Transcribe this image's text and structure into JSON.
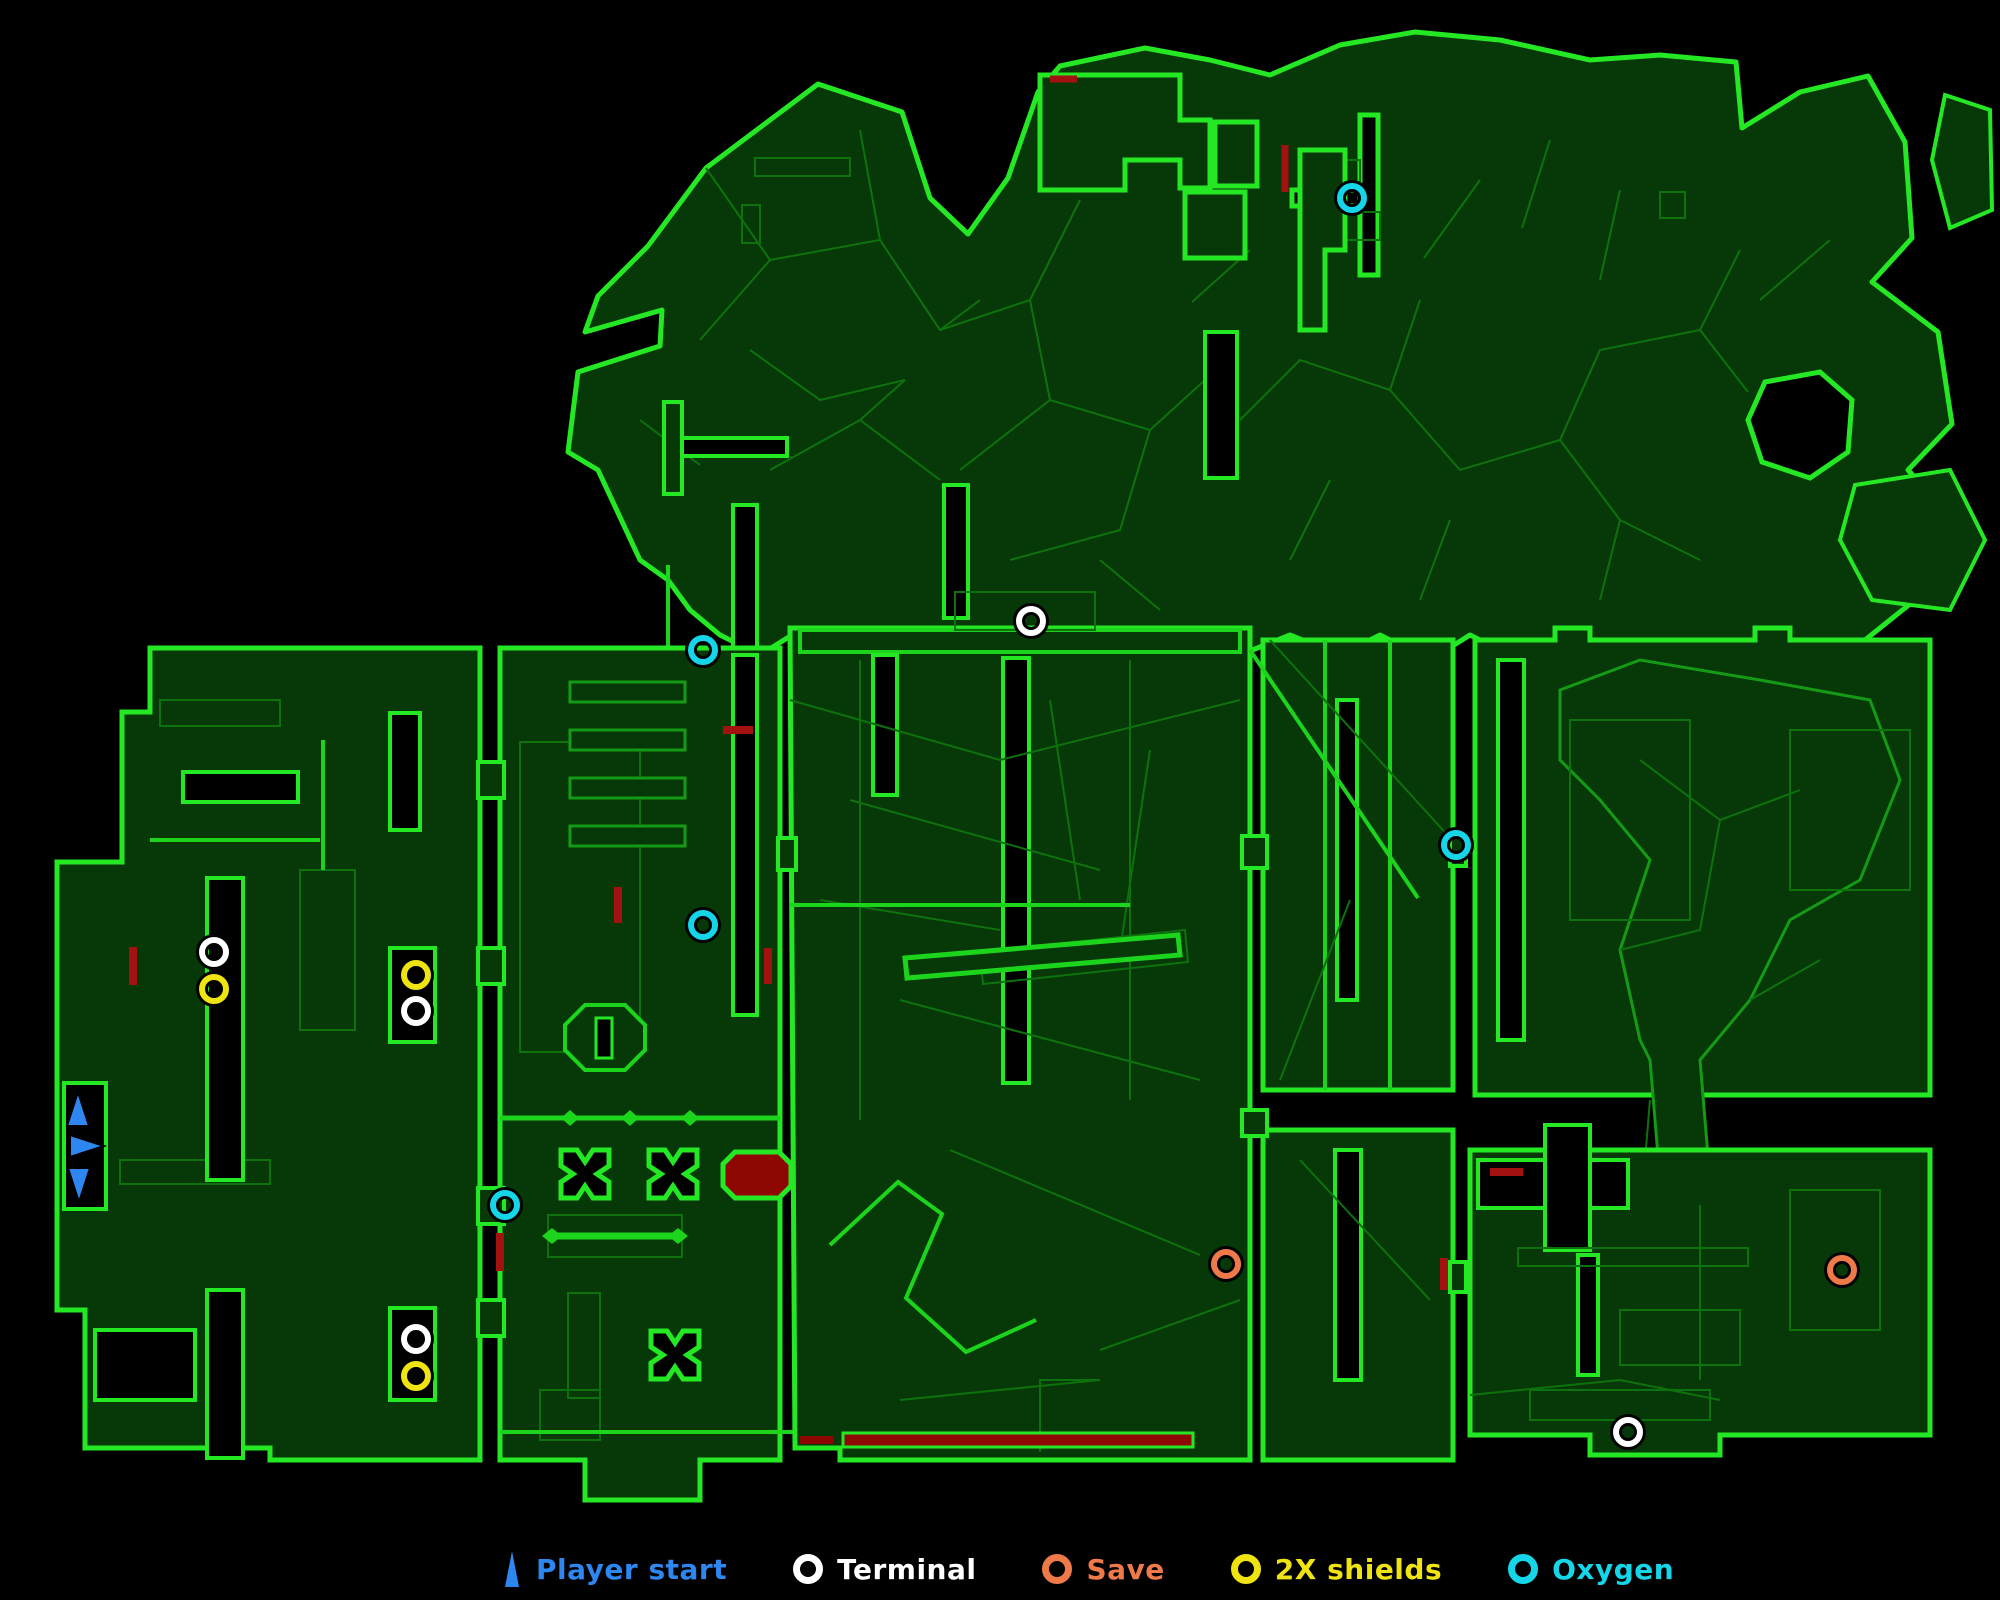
{
  "map": {
    "name": "overhead-automap",
    "colors": {
      "background": "#000000",
      "floor_fill": "#073807",
      "mesh_dim": "#0d720d",
      "mesh_mid": "#149a14",
      "outline_bright": "#24e824",
      "corridor": "#1bd41b",
      "hazard_red_fill": "#8e0703",
      "door_red": "#a31111"
    }
  },
  "legend": {
    "items": [
      {
        "id": "player-start",
        "label": "Player start",
        "color": "#2e86f0",
        "icon": "triangle"
      },
      {
        "id": "terminal",
        "label": "Terminal",
        "color": "#ffffff",
        "icon": "ring"
      },
      {
        "id": "save",
        "label": "Save",
        "color": "#f0794a",
        "icon": "ring"
      },
      {
        "id": "shields",
        "label": "2X shields",
        "color": "#efe312",
        "icon": "ring"
      },
      {
        "id": "oxygen",
        "label": "Oxygen",
        "color": "#14d6e8",
        "icon": "ring"
      }
    ]
  },
  "scale": {
    "label": "4 WU",
    "units": 4,
    "color": "#1ec41e"
  },
  "markers": {
    "terminal": {
      "color": "#ffffff",
      "points": [
        [
          1031,
          621
        ],
        [
          214,
          952
        ],
        [
          416,
          1011
        ],
        [
          416,
          1339
        ],
        [
          1628,
          1432
        ]
      ]
    },
    "save": {
      "color": "#f0794a",
      "points": [
        [
          1226,
          1264
        ],
        [
          1842,
          1270
        ]
      ]
    },
    "shields": {
      "color": "#efe312",
      "points": [
        [
          214,
          989
        ],
        [
          416,
          975
        ],
        [
          416,
          1376
        ]
      ]
    },
    "oxygen": {
      "color": "#14d6e8",
      "points": [
        [
          1352,
          198
        ],
        [
          703,
          650
        ],
        [
          703,
          925
        ],
        [
          1456,
          845
        ],
        [
          505,
          1205
        ]
      ]
    }
  },
  "player_starts": [
    {
      "x": 78,
      "y": 1112,
      "dir": "up"
    },
    {
      "x": 84,
      "y": 1146,
      "dir": "right"
    },
    {
      "x": 79,
      "y": 1182,
      "dir": "down"
    }
  ]
}
